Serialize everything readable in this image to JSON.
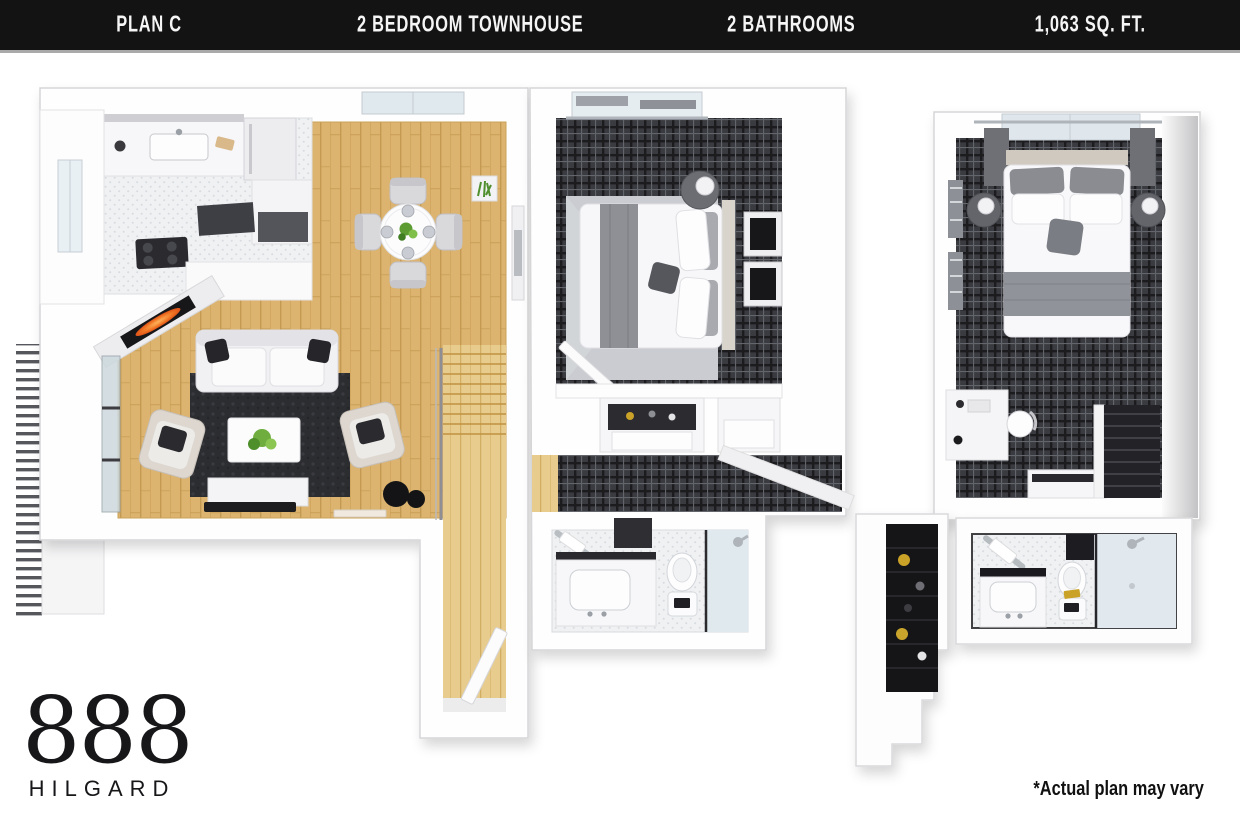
{
  "header": {
    "plan": "PLAN C",
    "unit_type": "2 BEDROOM TOWNHOUSE",
    "bathrooms": "2 BATHROOMS",
    "area": "1,063 SQ. FT."
  },
  "branding": {
    "logo_number": "888",
    "logo_name": "HILGARD"
  },
  "disclaimer": "*Actual plan may vary",
  "floor_plan": {
    "style": "3d-top-down-render",
    "floors": [
      {
        "name": "first-floor",
        "rooms": [
          "kitchen",
          "dining-area",
          "living-room",
          "balcony",
          "fireplace",
          "stairs",
          "entry"
        ]
      },
      {
        "name": "second-floor",
        "rooms": [
          "bedroom-1",
          "closet-niches",
          "hallway",
          "bathroom-1",
          "bedroom-2",
          "walk-in-closet",
          "bathroom-2"
        ]
      }
    ],
    "colors": {
      "header_bg": "#131313",
      "header_text": "#f5f5f5",
      "wall": "#ffffff",
      "wood_floor": "#dcb46f",
      "light_wood": "#e8cc8e",
      "carpet_plaid": "#3a3b40",
      "tile": "#eff1f3",
      "rug_dark": "#2c2d31",
      "rug_light": "#caccd1",
      "flame": "#e8541d",
      "plant": "#6fae3e"
    }
  }
}
